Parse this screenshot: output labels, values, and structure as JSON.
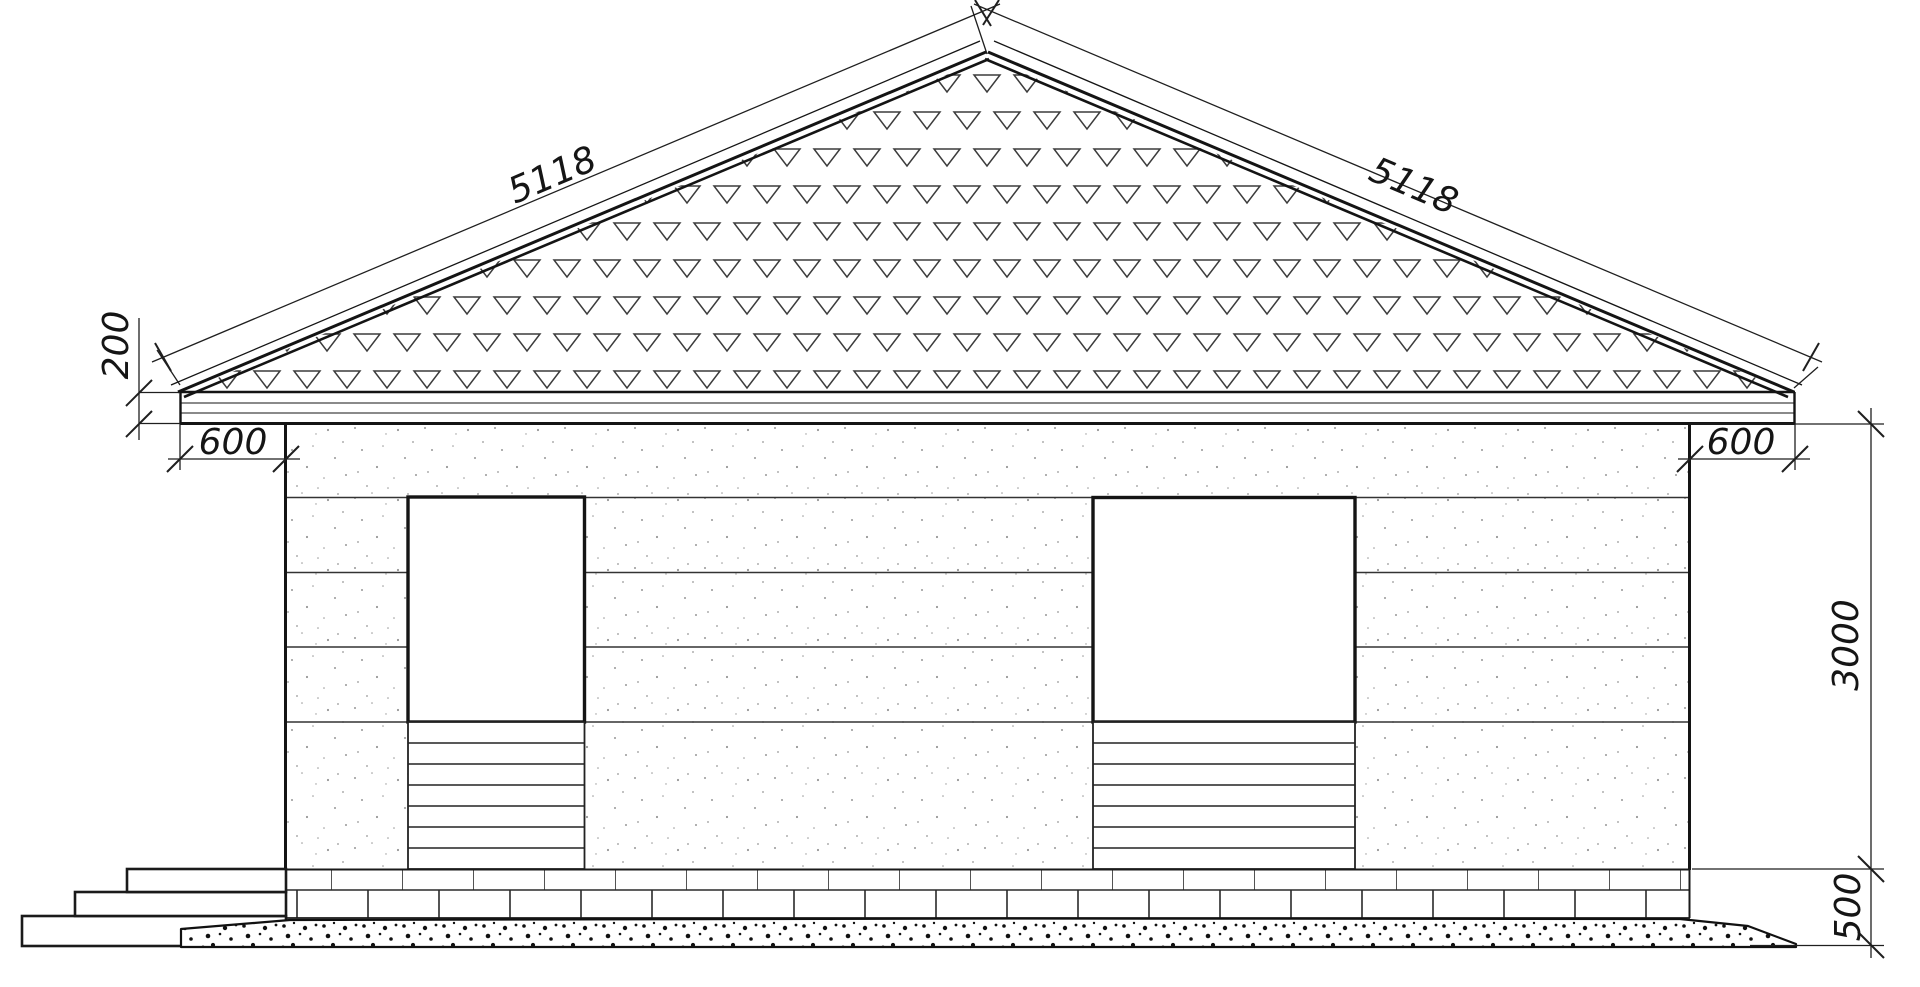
{
  "drawing": {
    "type": "architectural-elevation-side-view",
    "labels": {
      "roof_slope_left": "5118",
      "roof_slope_right": "5118",
      "roof_edge_height": "200",
      "eave_overhang_left": "600",
      "eave_overhang_right": "600",
      "wall_height": "3000",
      "base_height": "500"
    },
    "colors": {
      "line": "#1f1f1f",
      "thin_line": "#3c3c3c",
      "background": "#ffffff"
    }
  }
}
